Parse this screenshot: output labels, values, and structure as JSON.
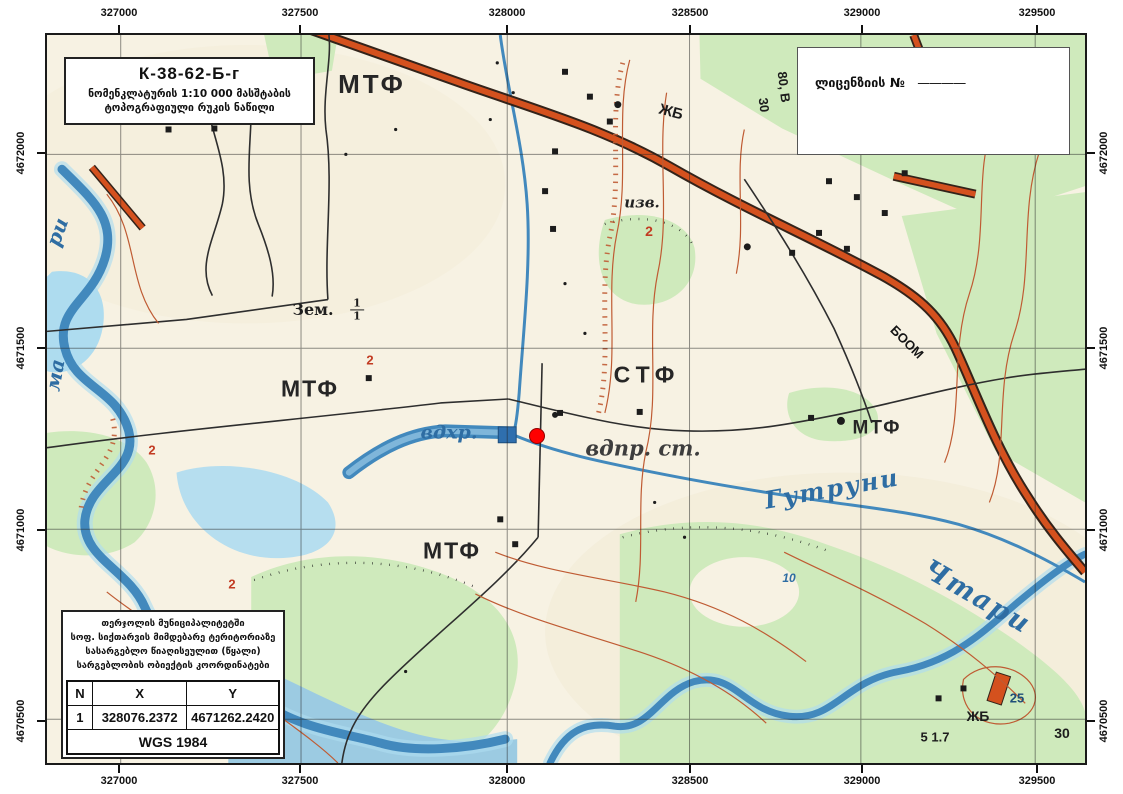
{
  "frame": {
    "eastings": [
      "327000",
      "327500",
      "328000",
      "328500",
      "329000",
      "329500"
    ],
    "northings": [
      "4672000",
      "4671500",
      "4671000",
      "4670500"
    ]
  },
  "title_box": {
    "code": "К-38-62-Б-г",
    "line1": "ნომენკლატურის 1:10 000 მასშტაბის",
    "line2": "ტოპოგრაფიული რუკის ნაწილი"
  },
  "license_box": {
    "label": "ლიცენზიის №",
    "dash": "————"
  },
  "info_box": {
    "lines": [
      "თერჯოლის მუნიციპალიტეტში",
      "სოფ. სიქთარვის მიმდებარე ტერიტორიაზე",
      "სასარგებლო წიაღისეულით (წყალი)",
      "სარგებლობის ობიექტის კოორდინატები"
    ],
    "table": {
      "headers": [
        "N",
        "X",
        "Y"
      ],
      "rows": [
        [
          "1",
          "328076.2372",
          "4671262.2420"
        ]
      ],
      "footer": "WGS 1984"
    }
  },
  "marker": {
    "color": "#ff0000"
  },
  "colors": {
    "paper": "#f7f2e3",
    "water": "#4289bd",
    "water_light": "#aedcef",
    "road": "#d4511e",
    "vegetation": "#cfeabc",
    "contour": "#bf5b33",
    "grid": "#222222",
    "marker": "#ff0000"
  },
  "map_labels": [
    {
      "name": "label-mtf-1",
      "text": "МТФ",
      "x": 325,
      "y": 49,
      "size": 26,
      "color": "#262626",
      "ls": 3
    },
    {
      "name": "label-zhb-1",
      "text": "ЖБ",
      "x": 624,
      "y": 77,
      "size": 15,
      "rotate": 15,
      "color": "#1c1c1c"
    },
    {
      "name": "label-road-80v",
      "text": "80, В",
      "x": 737,
      "y": 52,
      "size": 13,
      "rotate": 83,
      "color": "#1c1c1c"
    },
    {
      "name": "label-road-30",
      "text": "30",
      "x": 717,
      "y": 70,
      "size": 13,
      "rotate": 83,
      "color": "#1c1c1c"
    },
    {
      "name": "label-izv",
      "text": "изв.",
      "x": 595,
      "y": 168,
      "size": 15,
      "italic": true,
      "serif": true,
      "color": "#222222"
    },
    {
      "name": "label-red-2a",
      "text": "2",
      "x": 602,
      "y": 196,
      "size": 14,
      "color": "#c23b22"
    },
    {
      "name": "label-zem",
      "text": "Зем.",
      "x": 266,
      "y": 275,
      "size": 16,
      "serif": true,
      "color": "#1e1e1e"
    },
    {
      "name": "label-zem-fraction",
      "type": "fraction",
      "num": "1",
      "den": "1",
      "x": 310,
      "y": 275,
      "size": 11,
      "serif": true,
      "color": "#1e1e1e"
    },
    {
      "name": "label-mtf-2",
      "text": "МТФ",
      "x": 263,
      "y": 354,
      "size": 23,
      "color": "#262626",
      "ls": 2
    },
    {
      "name": "label-red-2b",
      "text": "2",
      "x": 323,
      "y": 325,
      "size": 13,
      "color": "#c23b22"
    },
    {
      "name": "label-stf",
      "text": "СТФ",
      "x": 600,
      "y": 340,
      "size": 23,
      "color": "#262626",
      "ls": 6
    },
    {
      "name": "label-vdkhr",
      "text": "вдхр.",
      "x": 402,
      "y": 398,
      "size": 19,
      "italic": true,
      "serif": true,
      "color": "#2e6da3"
    },
    {
      "name": "label-vdpr-st",
      "text": "вдпр. ст.",
      "x": 596,
      "y": 413,
      "size": 21,
      "italic": true,
      "serif": true,
      "color": "#3d3d3d"
    },
    {
      "name": "label-mtf-3",
      "text": "МТФ",
      "x": 830,
      "y": 393,
      "size": 19,
      "color": "#262626",
      "ls": 2
    },
    {
      "name": "label-gutruni",
      "text": "Гутруни",
      "x": 785,
      "y": 454,
      "size": 24,
      "italic": true,
      "serif": true,
      "color": "#2e6da3",
      "rotate": -10,
      "ls": 2
    },
    {
      "name": "label-mtf-4",
      "text": "МТФ",
      "x": 405,
      "y": 516,
      "size": 23,
      "color": "#262626",
      "ls": 2
    },
    {
      "name": "label-red-2c",
      "text": "2",
      "x": 185,
      "y": 549,
      "size": 13,
      "color": "#c23b22"
    },
    {
      "name": "label-red-2d",
      "text": "2",
      "x": 105,
      "y": 415,
      "size": 13,
      "color": "#c23b22"
    },
    {
      "name": "label-blue-10",
      "text": "10",
      "x": 742,
      "y": 543,
      "size": 12,
      "italic": true,
      "color": "#2e6da3"
    },
    {
      "name": "label-chtari",
      "text": "Чтари",
      "x": 930,
      "y": 562,
      "size": 27,
      "italic": true,
      "serif": true,
      "color": "#2e6da3",
      "rotate": 30,
      "ls": 2
    },
    {
      "name": "label-boom",
      "text": "БООМ",
      "x": 860,
      "y": 307,
      "size": 13,
      "rotate": 45,
      "color": "#141414"
    },
    {
      "name": "label-zhb-2",
      "text": "ЖБ",
      "x": 931,
      "y": 681,
      "size": 14,
      "color": "#1c1c1c"
    },
    {
      "name": "label-25",
      "text": "25",
      "x": 970,
      "y": 663,
      "size": 13,
      "color": "#1f4e79"
    },
    {
      "name": "label-30b",
      "text": "30",
      "x": 1015,
      "y": 698,
      "size": 14,
      "color": "#1c1c1c"
    },
    {
      "name": "label-5-17",
      "text": "5 1.7",
      "x": 888,
      "y": 702,
      "size": 13,
      "color": "#1c1c1c"
    },
    {
      "name": "label-river-partial-1",
      "text": "ри",
      "x": 10,
      "y": 197,
      "size": 20,
      "italic": true,
      "serif": true,
      "color": "#2e6da3",
      "rotate": -70
    },
    {
      "name": "label-river-partial-2",
      "text": "ма",
      "x": 8,
      "y": 340,
      "size": 20,
      "italic": true,
      "serif": true,
      "color": "#2e6da3",
      "rotate": -80
    }
  ]
}
